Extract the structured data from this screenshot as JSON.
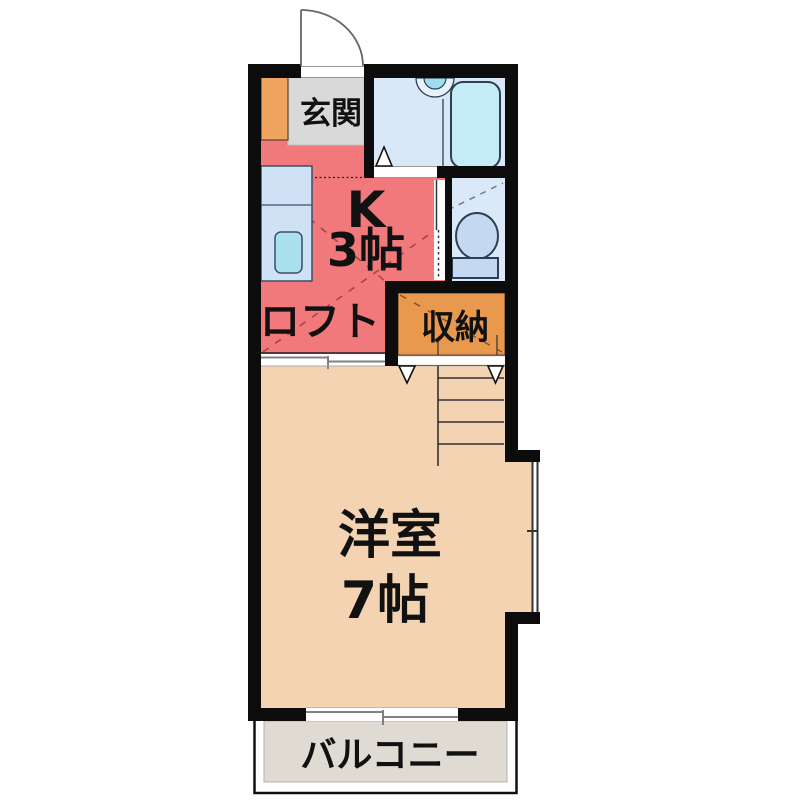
{
  "floorplan": {
    "background_color": "#ffffff",
    "wall_color": "#0c0c0c",
    "rooms": {
      "entrance": {
        "label": "玄関",
        "floor_color": "#d9d9d9"
      },
      "shoe_cabinet": {
        "color": "#efa55f"
      },
      "kitchen": {
        "size_label_line1": "K",
        "size_label_line2": "3帖",
        "floor_color": "#f1797b"
      },
      "loft": {
        "label": "ロフト"
      },
      "bathroom": {
        "floor_color": "#d9e7f7",
        "bathtub_color": "#c3ecf6",
        "sink_color": "#9fdcec"
      },
      "toilet": {
        "floor_color": "#dbe8f8",
        "fixture_color": "#c4d8f2"
      },
      "storage": {
        "label": "収納",
        "floor_color": "#e9994e"
      },
      "western_room": {
        "label_line1": "洋室",
        "label_line2": "7帖",
        "floor_color": "#f3d3b2"
      },
      "balcony": {
        "label": "バルコニー",
        "floor_color": "#dfdad2"
      }
    }
  }
}
